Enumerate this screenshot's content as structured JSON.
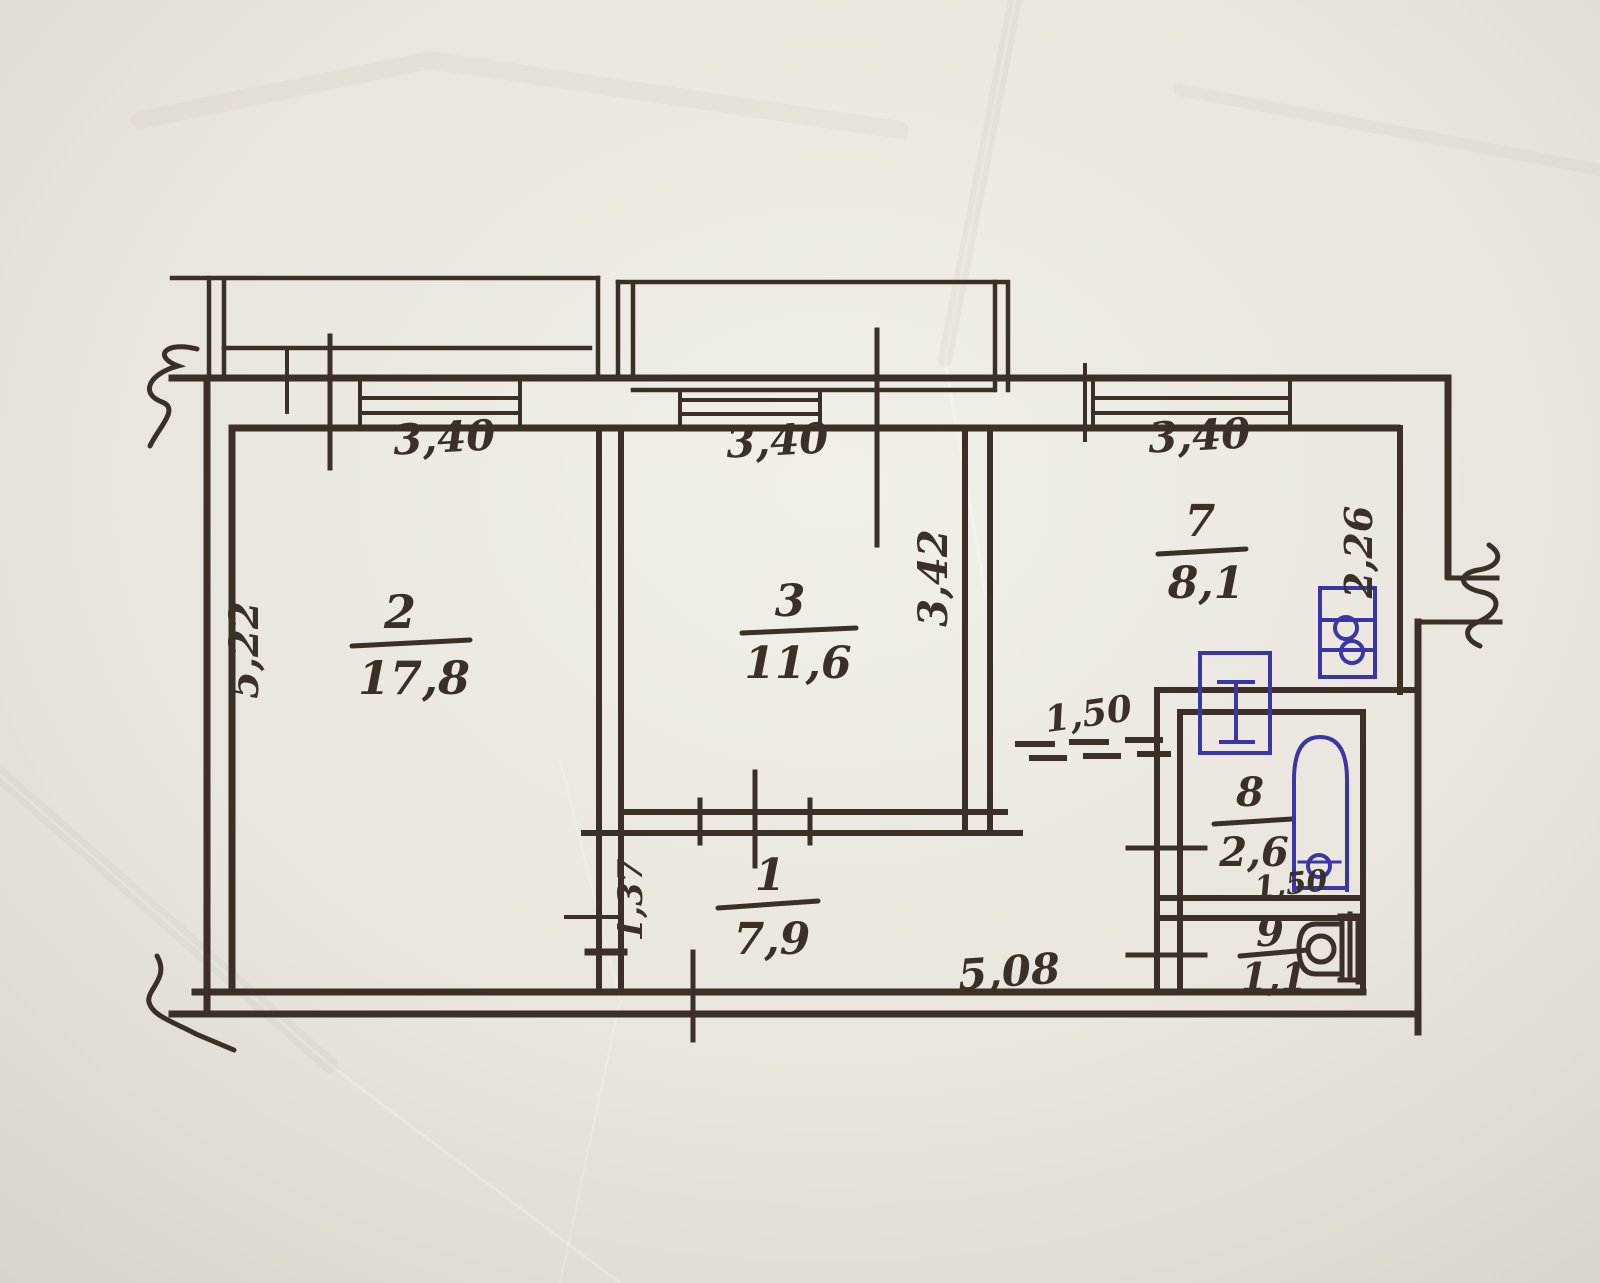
{
  "plan": {
    "colors": {
      "ink": "#3a3027",
      "fixture_blue": "#3c35a5",
      "paper": "#e9e5dd"
    },
    "rooms": [
      {
        "number": "2",
        "area": "17,8"
      },
      {
        "number": "3",
        "area": "11,6"
      },
      {
        "number": "1",
        "area": "7,9"
      },
      {
        "number": "7",
        "area": "8,1"
      },
      {
        "number": "8",
        "area": "2,6",
        "width": "1,50"
      },
      {
        "number": "9",
        "area": "1,1"
      }
    ],
    "dims": {
      "window2": "3,40",
      "window3": "3,40",
      "window7": "3,40",
      "left": "5,22",
      "room3_right": "3,42",
      "kitchen_right": "2,26",
      "passage": "1,50",
      "hall_left": "1,37",
      "bottom": "5,08"
    }
  }
}
